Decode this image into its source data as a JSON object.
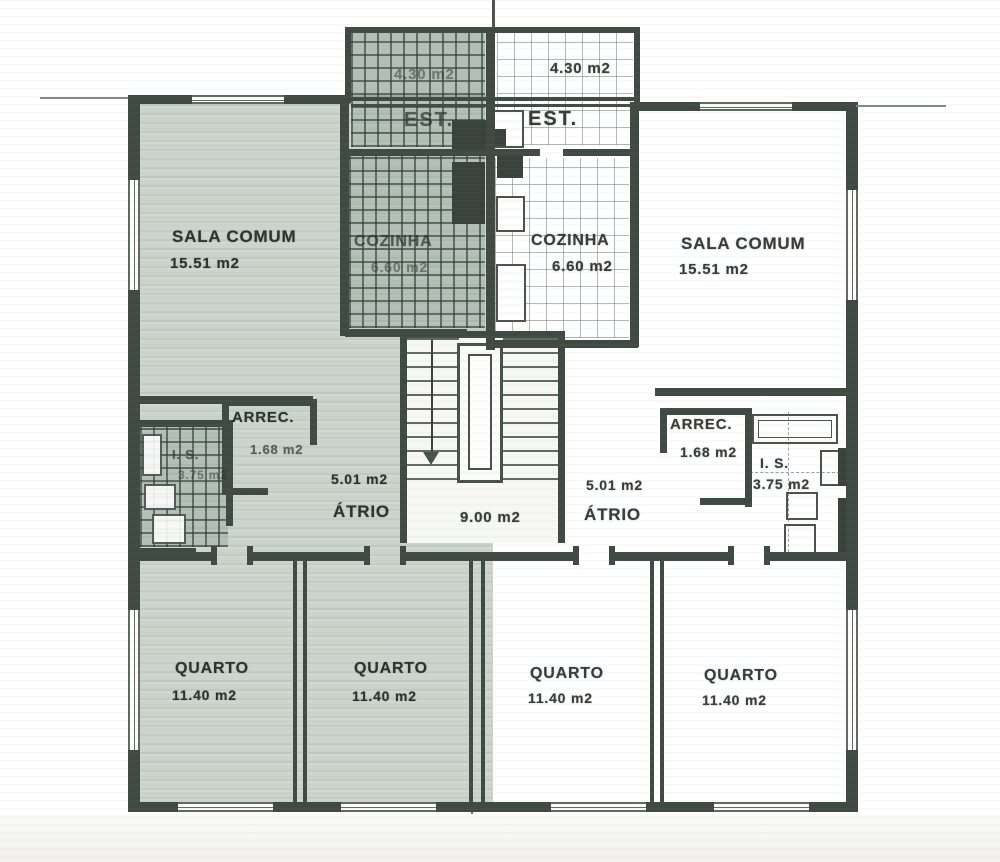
{
  "document": {
    "type": "scanned residential floor plan, two mirrored apartments"
  },
  "colors": {
    "left_apartment_tint": "#9eae9f",
    "wall": "#3f4a42",
    "paper": "#ffffff",
    "text": "#363c37"
  },
  "rooms": {
    "est_left": {
      "label": "EST.",
      "area": "4.30 m2"
    },
    "est_right": {
      "label": "EST.",
      "area": "4.30 m2"
    },
    "sala_comum_left": {
      "label": "SALA COMUM",
      "area": "15.51 m2"
    },
    "sala_comum_right": {
      "label": "SALA COMUM",
      "area": "15.51 m2"
    },
    "cozinha_left": {
      "label": "COZINHA",
      "area": "6.60 m2"
    },
    "cozinha_right": {
      "label": "COZINHA",
      "area": "6.60 m2"
    },
    "arrec_left": {
      "label": "ARREC.",
      "area": "1.68 m2"
    },
    "arrec_right": {
      "label": "ARREC.",
      "area": "1.68 m2"
    },
    "is_left": {
      "label": "I. S.",
      "area": "3.75 m2"
    },
    "is_right": {
      "label": "I. S.",
      "area": "3.75 m2"
    },
    "atrio_left": {
      "label": "ÁTRIO",
      "area": "5.01 m2"
    },
    "atrio_right": {
      "label": "ÁTRIO",
      "area": "5.01 m2"
    },
    "stairwell": {
      "area": "9.00 m2"
    },
    "quarto_1": {
      "label": "QUARTO",
      "area": "11.40 m2"
    },
    "quarto_2": {
      "label": "QUARTO",
      "area": "11.40 m2"
    },
    "quarto_3": {
      "label": "QUARTO",
      "area": "11.40 m2"
    },
    "quarto_4": {
      "label": "QUARTO",
      "area": "11.40 m2"
    }
  }
}
